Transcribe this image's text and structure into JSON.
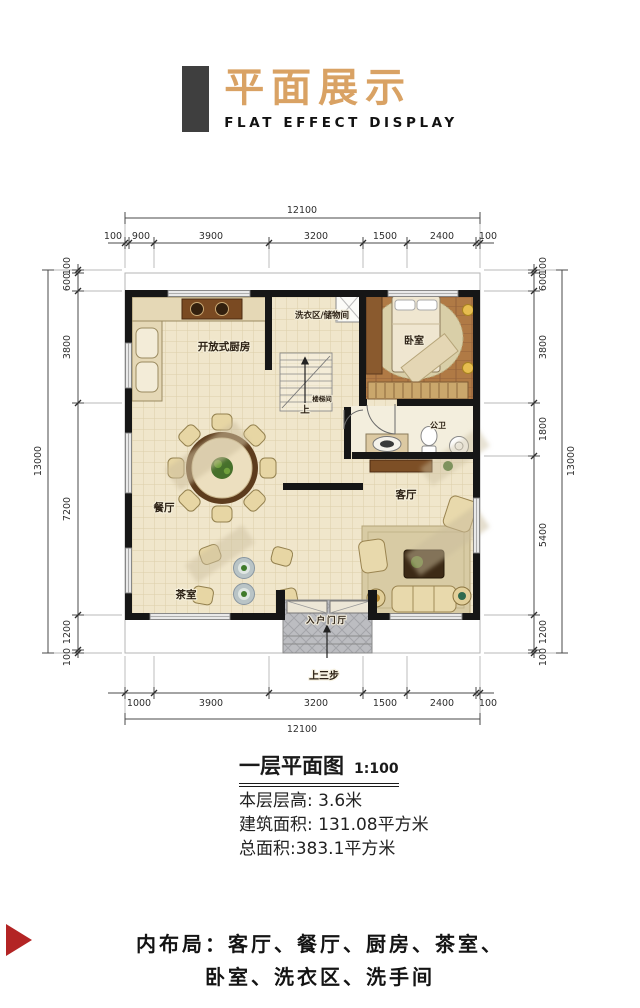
{
  "header": {
    "title": "平面展示",
    "subtitle": "FLAT EFFECT DISPLAY"
  },
  "plan": {
    "dims": {
      "top_total": "12100",
      "top_segments": [
        "100",
        "900",
        "3900",
        "3200",
        "1500",
        "2400",
        "100"
      ],
      "bottom_segments": [
        "1000",
        "3900",
        "3200",
        "1500",
        "2400",
        "100"
      ],
      "bottom_total": "12100",
      "left_total": "13000",
      "left_segments": [
        "100",
        "600",
        "3800",
        "7200",
        "1200",
        "100"
      ],
      "right_total": "13000",
      "right_segments": [
        "100",
        "600",
        "3800",
        "1800",
        "5400",
        "1200",
        "100"
      ]
    },
    "rooms": {
      "kitchen": "开放式厨房",
      "laundry": "洗衣区/储物间",
      "stairwell": "楼梯间",
      "up": "上",
      "bedroom": "卧室",
      "bathroom": "公卫",
      "living": "客厅",
      "dining": "餐厅",
      "tea": "茶室",
      "entry": "入户门厅",
      "steps": "上三步"
    }
  },
  "caption": {
    "title": "一层平面图",
    "scale": "1:100"
  },
  "info": {
    "floor_height": "本层层高: 3.6米",
    "build_area": "建筑面积: 131.08平方米",
    "total_area": "总面积:383.1平方米"
  },
  "footer": {
    "line1": "内布局：客厅、餐厅、厨房、茶室、",
    "line2": "卧室、洗衣区、洗手间"
  },
  "colors": {
    "accent_gold": "#d9a264",
    "bar_dark": "#3f3f3f",
    "triangle_red": "#b32424"
  }
}
